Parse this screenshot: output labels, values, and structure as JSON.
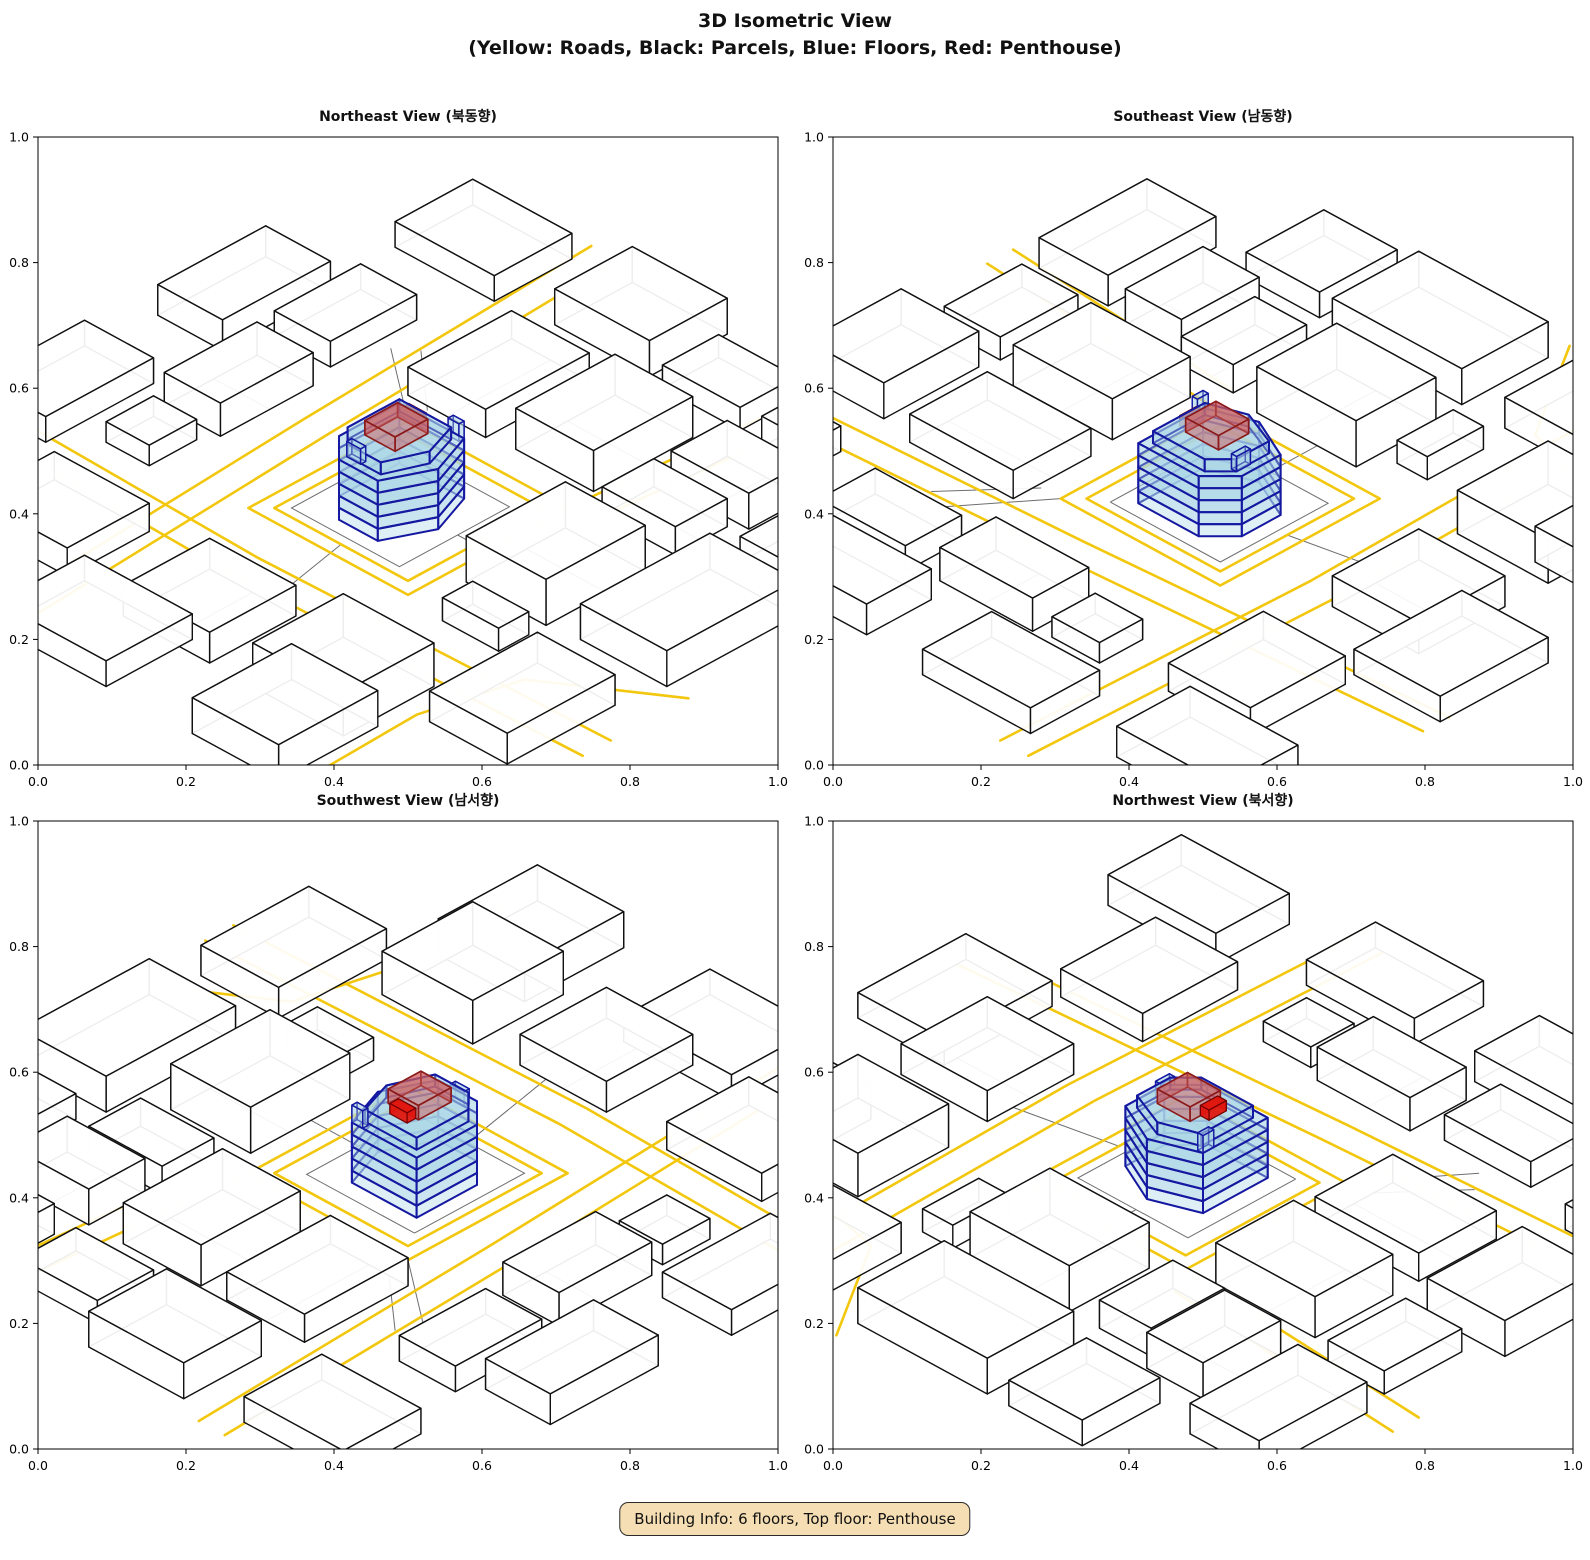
{
  "figure": {
    "title_line1": "3D Isometric View",
    "title_line2": "(Yellow: Roads, Black: Parcels, Blue: Floors, Red: Penthouse)"
  },
  "badge": {
    "text": "Building Info: 6 floors, Top floor: Penthouse"
  },
  "axis": {
    "min": 0.0,
    "max": 1.0,
    "tick_labels": [
      "0.0",
      "0.2",
      "0.4",
      "0.6",
      "0.8",
      "1.0"
    ]
  },
  "legend_meaning": {
    "yellow": "Roads",
    "black": "Parcels",
    "blue": "Floors",
    "red": "Penthouse"
  },
  "colors": {
    "road": "#F2C70E",
    "parcel_edge": "#111111",
    "parcel_fill": "rgba(255,255,255,0.93)",
    "ground_line": "#6e6e6e",
    "floor_fill": "rgba(173,216,230,0.40)",
    "floor_edge": "#1518A0",
    "penthouse_fill": "rgba(205,92,92,0.50)",
    "penthouse_edge": "#8B1A1A",
    "core_fill": "rgba(224,24,16,0.95)",
    "core_edge": "#700000",
    "badge_bg": "#F5DEB3",
    "axes_edge": "#000000"
  },
  "views": [
    {
      "key": "northeast",
      "title": "Northeast View (북동향)",
      "azimuth": 45,
      "elevation": 33
    },
    {
      "key": "southeast",
      "title": "Southeast View (남동향)",
      "azimuth": 315,
      "elevation": 33
    },
    {
      "key": "southwest",
      "title": "Southwest View (남서향)",
      "azimuth": 225,
      "elevation": 33
    },
    {
      "key": "northwest",
      "title": "Northwest View (북서향)",
      "azimuth": 135,
      "elevation": 33
    }
  ],
  "building": {
    "floors": 6,
    "top_floor": "Penthouse",
    "floor_height": 0.0235,
    "footprint": [
      [
        0.435,
        0.415
      ],
      [
        0.575,
        0.415
      ],
      [
        0.625,
        0.465
      ],
      [
        0.625,
        0.555
      ],
      [
        0.53,
        0.6
      ],
      [
        0.435,
        0.565
      ]
    ],
    "top_floor_footprint": [
      [
        0.452,
        0.432
      ],
      [
        0.572,
        0.432
      ],
      [
        0.608,
        0.468
      ],
      [
        0.608,
        0.545
      ],
      [
        0.528,
        0.578
      ],
      [
        0.452,
        0.552
      ]
    ],
    "penthouse": {
      "rect": [
        0.492,
        0.468,
        0.568,
        0.538
      ],
      "z0": 0.141,
      "h": 0.028
    },
    "core": {
      "rect": [
        0.472,
        0.474,
        0.492,
        0.514
      ],
      "z0": 0.141,
      "h": 0.02
    },
    "fins": [
      {
        "rect": [
          0.435,
          0.54,
          0.447,
          0.565
        ],
        "z0": 0.1175,
        "h": 0.034
      },
      {
        "rect": [
          0.598,
          0.468,
          0.61,
          0.5
        ],
        "z0": 0.1175,
        "h": 0.03
      }
    ]
  },
  "city": {
    "blocks": [
      {
        "rect": [
          0.04,
          0.78,
          0.17,
          0.96
        ],
        "h": 0.07
      },
      {
        "rect": [
          0.19,
          0.76,
          0.31,
          0.93
        ],
        "h": 0.055
      },
      {
        "rect": [
          0.38,
          0.745,
          0.61,
          0.93
        ],
        "h": 0.09
      },
      {
        "rect": [
          0.65,
          0.8,
          0.72,
          0.93
        ],
        "h": 0.045
      },
      {
        "rect": [
          0.87,
          0.72,
          1.08,
          0.93
        ],
        "h": 0.085
      },
      {
        "rect": [
          0.88,
          0.42,
          1.08,
          0.62
        ],
        "h": 0.06
      },
      {
        "rect": [
          0.87,
          0.05,
          1.06,
          0.27
        ],
        "h": 0.055
      },
      {
        "rect": [
          0.62,
          0.03,
          0.73,
          0.13
        ],
        "h": 0.04
      },
      {
        "rect": [
          0.37,
          0.02,
          0.585,
          0.15
        ],
        "h": 0.065
      },
      {
        "rect": [
          0.11,
          0.0,
          0.31,
          0.13
        ],
        "h": 0.05
      },
      {
        "rect": [
          0.04,
          0.28,
          0.28,
          0.46
        ],
        "h": 0.055
      },
      {
        "rect": [
          0.04,
          0.52,
          0.27,
          0.7
        ],
        "h": 0.08
      },
      {
        "rect": [
          -0.18,
          0.8,
          -0.02,
          1.05
        ],
        "h": 0.06
      },
      {
        "rect": [
          0.3,
          1.0,
          0.6,
          1.2
        ],
        "h": 0.07
      },
      {
        "rect": [
          0.7,
          1.0,
          0.95,
          1.18
        ],
        "h": 0.06
      },
      {
        "rect": [
          1.02,
          0.75,
          1.25,
          0.95
        ],
        "h": 0.07
      },
      {
        "rect": [
          1.05,
          0.3,
          1.25,
          0.55
        ],
        "h": 0.05
      },
      {
        "rect": [
          0.95,
          -0.15,
          1.2,
          0.02
        ],
        "h": 0.06
      },
      {
        "rect": [
          0.55,
          -0.2,
          0.8,
          -0.04
        ],
        "h": 0.05
      },
      {
        "rect": [
          0.15,
          -0.18,
          0.4,
          -0.03
        ],
        "h": 0.06
      },
      {
        "rect": [
          -0.2,
          -0.05,
          -0.02,
          0.18
        ],
        "h": 0.05
      },
      {
        "rect": [
          -0.22,
          0.3,
          -0.04,
          0.52
        ],
        "h": 0.07
      },
      {
        "rect": [
          0.08,
          1.02,
          0.25,
          1.2
        ],
        "h": 0.05
      },
      {
        "rect": [
          -0.16,
          0.56,
          -0.03,
          0.74
        ],
        "h": 0.045
      }
    ],
    "roads": [
      [
        [
          0.335,
          0.335
        ],
        [
          0.705,
          0.335
        ],
        [
          0.705,
          0.705
        ],
        [
          0.335,
          0.705
        ],
        [
          0.335,
          0.335
        ]
      ],
      [
        [
          0.365,
          0.365
        ],
        [
          0.675,
          0.365
        ],
        [
          0.675,
          0.675
        ],
        [
          0.365,
          0.675
        ],
        [
          0.365,
          0.365
        ]
      ],
      [
        [
          -0.25,
          0.175
        ],
        [
          0.45,
          0.21
        ],
        [
          1.25,
          0.26
        ]
      ],
      [
        [
          -0.25,
          0.235
        ],
        [
          0.45,
          0.27
        ],
        [
          1.25,
          0.32
        ]
      ],
      [
        [
          0.78,
          -0.25
        ],
        [
          0.8,
          0.45
        ],
        [
          0.78,
          1.25
        ]
      ],
      [
        [
          0.845,
          -0.25
        ],
        [
          0.865,
          0.45
        ],
        [
          0.845,
          1.25
        ]
      ],
      [
        [
          -0.25,
          0.75
        ],
        [
          0.335,
          0.705
        ]
      ],
      [
        [
          -0.25,
          0.81
        ],
        [
          0.3,
          0.765
        ]
      ],
      [
        [
          0.6,
          1.25
        ],
        [
          0.75,
          1.02
        ],
        [
          0.95,
          0.97
        ],
        [
          1.25,
          0.98
        ]
      ]
    ],
    "parcel_lines": [
      [
        [
          0.04,
          0.87
        ],
        [
          0.17,
          0.87
        ]
      ],
      [
        [
          0.25,
          0.76
        ],
        [
          0.25,
          0.93
        ]
      ],
      [
        [
          0.47,
          0.745
        ],
        [
          0.47,
          0.93
        ]
      ],
      [
        [
          0.88,
          0.52
        ],
        [
          1.08,
          0.52
        ]
      ],
      [
        [
          0.47,
          0.02
        ],
        [
          0.47,
          0.15
        ]
      ],
      [
        [
          0.04,
          0.37
        ],
        [
          0.28,
          0.37
        ]
      ],
      [
        [
          0.15,
          0.52
        ],
        [
          0.15,
          0.7
        ]
      ],
      [
        [
          0.4,
          0.385
        ],
        [
          0.655,
          0.385
        ],
        [
          0.655,
          0.635
        ],
        [
          0.4,
          0.635
        ],
        [
          0.4,
          0.385
        ]
      ],
      [
        [
          0.335,
          0.335
        ],
        [
          0.2,
          0.16
        ]
      ],
      [
        [
          0.29,
          0.335
        ],
        [
          0.17,
          0.2
        ]
      ],
      [
        [
          0.675,
          0.52
        ],
        [
          0.88,
          0.56
        ]
      ],
      [
        [
          0.52,
          0.635
        ],
        [
          0.52,
          0.745
        ]
      ]
    ]
  }
}
